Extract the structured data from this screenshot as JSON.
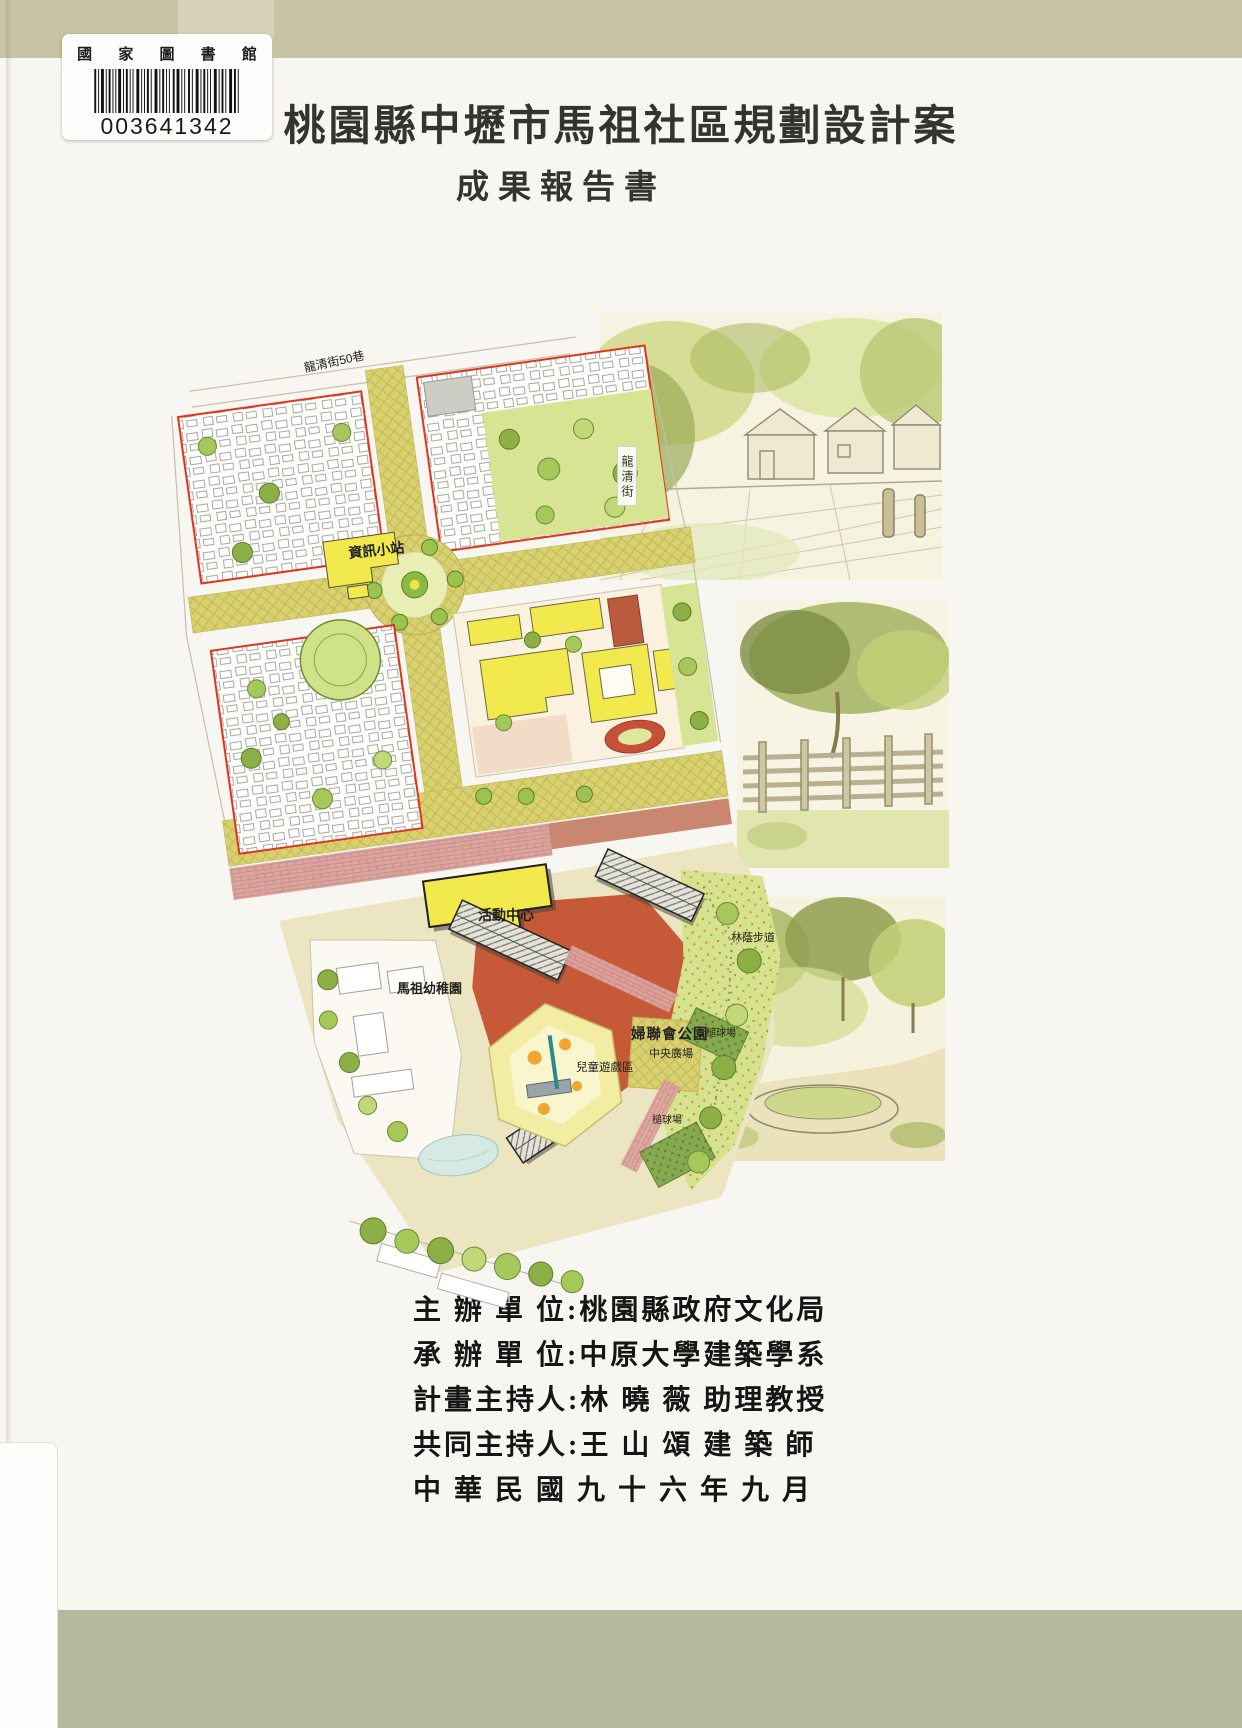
{
  "cover": {
    "title": "桃園縣中壢市馬祖社區規劃設計案",
    "subtitle": "成果報告書"
  },
  "library_label": {
    "institution": "國 家 圖 書 館",
    "barcode_number": "003641342",
    "barcode_icon": "barcode"
  },
  "site_plan": {
    "description": "hand-rendered community master plan, tilted about -8 degrees",
    "labels": {
      "street_top": "龍清街50巷",
      "street_right": "龍清街",
      "info_station": "資訊小站",
      "activity_center": "活動中心",
      "shaded_walk": "林蔭步道",
      "park_name": "婦聯會公園",
      "central_plaza": "中央廣場",
      "children_play_area": "兒童遊戲區",
      "gateball_court_upper": "槌球場",
      "gateball_court_lower": "槌球場",
      "kindergarten": "馬祖幼稚園"
    }
  },
  "credits": {
    "lines": [
      {
        "text": "主 辦 單 位:桃園縣政府文化局"
      },
      {
        "text": "承 辦 單 位:中原大學建築學系"
      },
      {
        "text": "計畫主持人:林 曉 薇 助理教授"
      },
      {
        "text": "共同主持人:王 山 頌 建 築 師"
      },
      {
        "text": "中 華 民 國 九 十 六 年 九 月"
      }
    ]
  },
  "colors": {
    "top_band": "#c8c3a4",
    "bottom_band": "#b5ba9e",
    "paper": "#f8f6f0",
    "map_road_khaki": "#d9d170",
    "map_red_boundary": "#e0341f",
    "map_terracotta_plaza": "#c65a38",
    "map_yellow_building": "#f2e94c",
    "map_pink_brick": "#dda49e",
    "map_lawn_green": "#d7e494",
    "map_tree_green": "#8cb046"
  }
}
